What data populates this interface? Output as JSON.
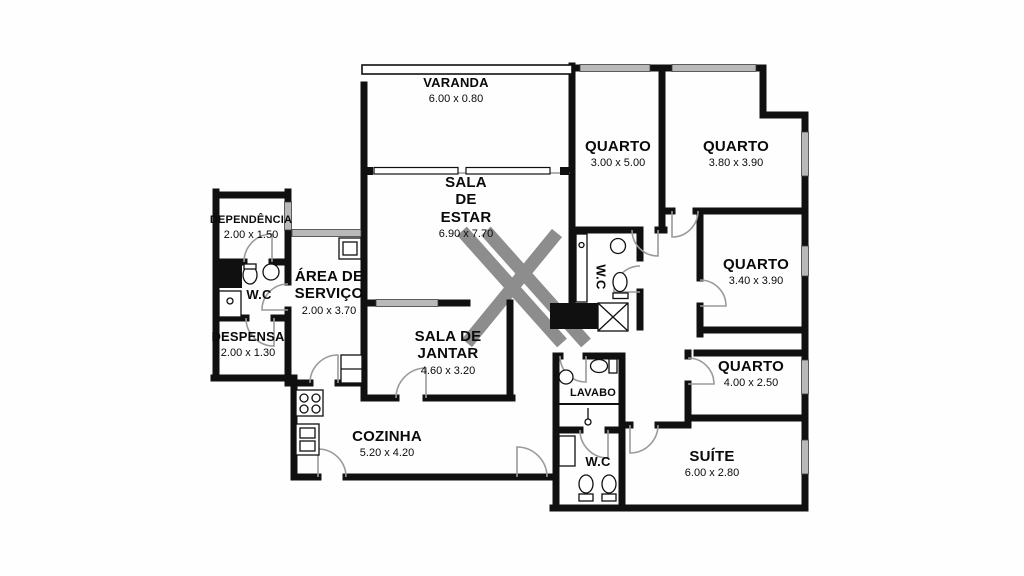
{
  "plan": {
    "type": "apartment-floor-plan",
    "watermark_symbol": "X",
    "colors": {
      "wall": "#101010",
      "window": "#b9b9b9",
      "floor": "#ffffff",
      "watermark": "#8d8d8d"
    }
  },
  "rooms": [
    {
      "id": "varanda",
      "name": "VARANDA",
      "dims": "6.00 x 0.80"
    },
    {
      "id": "sala-de-estar",
      "name": "SALA DE ESTAR",
      "name_lines": [
        "SALA",
        "DE",
        "ESTAR"
      ],
      "dims": "6.90 x 7.70"
    },
    {
      "id": "quarto-1",
      "name": "QUARTO",
      "dims": "3.00 x 5.00"
    },
    {
      "id": "quarto-2",
      "name": "QUARTO",
      "dims": "3.80 x 3.90"
    },
    {
      "id": "quarto-3",
      "name": "QUARTO",
      "dims": "3.40 x 3.90"
    },
    {
      "id": "quarto-4",
      "name": "QUARTO",
      "dims": "4.00 x 2.50"
    },
    {
      "id": "suite",
      "name": "SUÍTE",
      "dims": "6.00 x 2.80"
    },
    {
      "id": "dependencia",
      "name": "DEPENDÊNCIA",
      "dims": "2.00 x 1.50"
    },
    {
      "id": "wc-dependencia",
      "name": "W.C",
      "dims": ""
    },
    {
      "id": "area-de-servico",
      "name": "ÁREA DE SERVIÇO",
      "name_lines": [
        "ÁREA DE",
        "SERVIÇO"
      ],
      "dims": "2.00 x 3.70"
    },
    {
      "id": "despensa",
      "name": "DESPENSA",
      "dims": "2.00 x 1.30"
    },
    {
      "id": "sala-de-jantar",
      "name": "SALA DE JANTAR",
      "name_lines": [
        "SALA DE",
        "JANTAR"
      ],
      "dims": "4.60 x 3.20"
    },
    {
      "id": "cozinha",
      "name": "COZINHA",
      "dims": "5.20 x 4.20"
    },
    {
      "id": "wc-social",
      "name": "W.C",
      "dims": ""
    },
    {
      "id": "lavabo",
      "name": "LAVABO",
      "dims": ""
    },
    {
      "id": "wc-suite",
      "name": "W.C",
      "dims": ""
    }
  ]
}
